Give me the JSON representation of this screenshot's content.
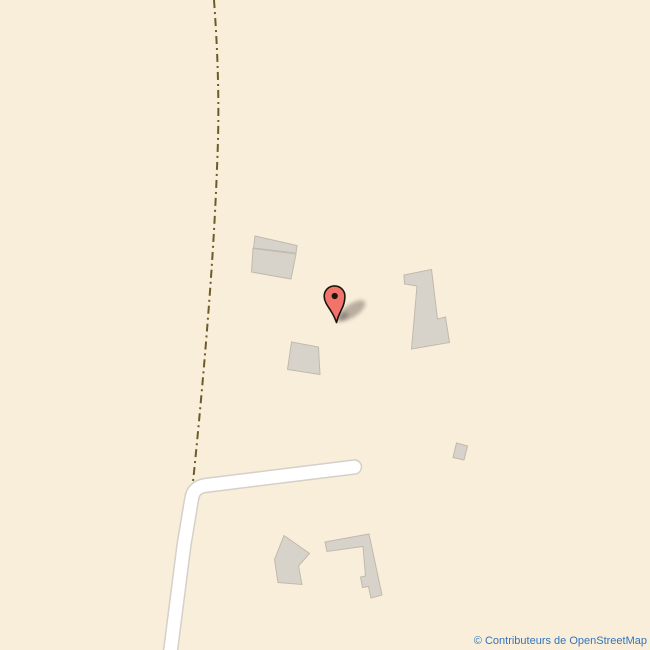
{
  "map": {
    "type": "openstreetmap-tile-view",
    "attribution_text": "© Contributeurs de OpenStreetMap",
    "marker": {
      "name": "red-location-pin",
      "approx_position_px": {
        "x": 336,
        "y": 322
      }
    },
    "features": {
      "track_style": "dashed dirt track",
      "road_style": "white minor road with gray casing",
      "building_count": 7
    }
  },
  "colors": {
    "map-bg": "#f9eed9",
    "building-fill": "#d8d3ca",
    "building-stroke": "#c1b9ae",
    "road-fill": "#ffffff",
    "road-casing": "#d4d0c9",
    "track": "#6b5c28",
    "marker-red": "#f1736a",
    "marker-outline": "#1c1410",
    "attribution": "#3474bb"
  }
}
